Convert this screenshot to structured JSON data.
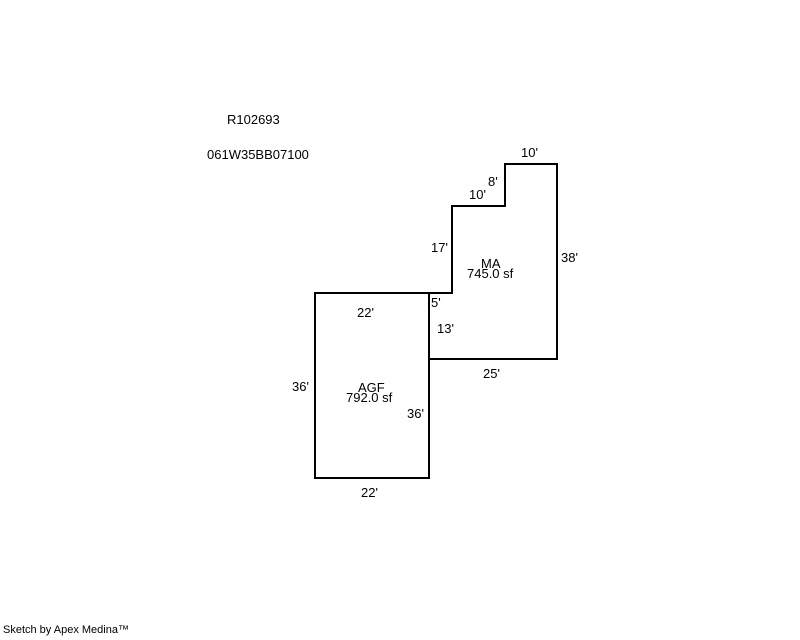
{
  "page": {
    "record_id": "R102693",
    "parcel_id": "061W35BB07100",
    "credit": "Sketch by Apex Medina™"
  },
  "sketch": {
    "line_color": "#000000",
    "background_color": "#ffffff",
    "areas": [
      {
        "code": "MA",
        "size": "745.0 sf"
      },
      {
        "code": "AGF",
        "size": "792.0 sf"
      }
    ],
    "dimensions": {
      "ma_top": "10'",
      "ma_notch_vertical": "8'",
      "ma_notch_horizontal": "10'",
      "ma_left_upper": "17'",
      "ma_right": "38'",
      "ma_step": "5'",
      "ma_left_lower": "13'",
      "ma_bottom": "25'",
      "agf_top": "22'",
      "agf_left": "36'",
      "agf_right": "36'",
      "agf_bottom": "22'"
    }
  }
}
